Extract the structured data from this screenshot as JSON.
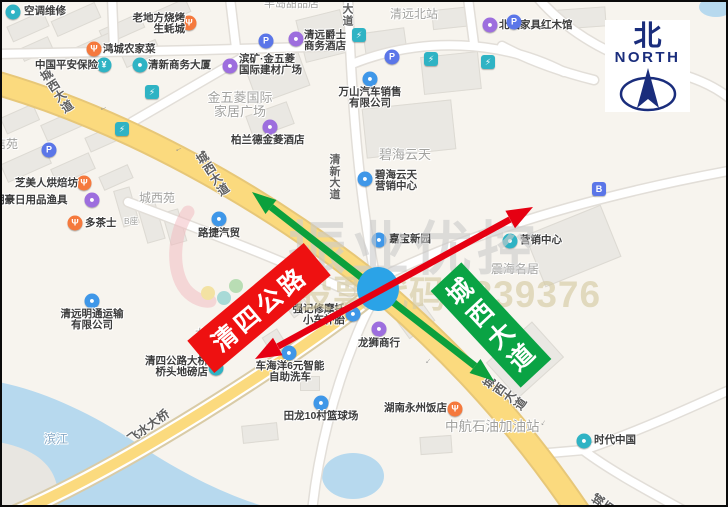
{
  "compass": {
    "zh": "北",
    "en": "NORTH"
  },
  "banners": {
    "red_label": "清四公路",
    "green_label": "城西大道"
  },
  "watermark": {
    "brand": "振业优控",
    "stock": "股票代码: 839376"
  },
  "colors": {
    "red_annotation": "#e60012",
    "green_annotation": "#0ca03c",
    "banner_red": "#ee1111",
    "banner_green": "#0aa344",
    "intersection_marker": "#2ba3e7",
    "compass_navy": "#1a2d7c",
    "main_road": "#fbda7e",
    "main_road_casing": "#e7c778",
    "minor_road": "#ffffff",
    "water": "#b7d9ee",
    "land": "#f7f4ee",
    "building": "#eae8e3",
    "poi_teal": "#2fb3c4",
    "poi_blue": "#3f97e8",
    "poi_orange": "#f5793d",
    "poi_purple": "#9d6ede",
    "poi_parking": "#5b76e8"
  },
  "road_labels": [
    {
      "t": "城西大道",
      "x": 55,
      "y": 89,
      "r": -33,
      "v": 1,
      "s": 12
    },
    {
      "t": "城西大道",
      "x": 211,
      "y": 172,
      "r": -33,
      "v": 1,
      "s": 12
    },
    {
      "t": "城西大道",
      "x": 503,
      "y": 391,
      "r": -55,
      "v": 1,
      "s": 12
    },
    {
      "t": "城西",
      "x": 602,
      "y": 502,
      "r": -55,
      "v": 1,
      "s": 12
    },
    {
      "t": "清新大道",
      "x": 333,
      "y": 176,
      "r": 0,
      "v": 1,
      "s": 11
    },
    {
      "t": "大道",
      "x": 346,
      "y": 14,
      "r": 0,
      "v": 1,
      "s": 11
    },
    {
      "t": "飞水大桥",
      "x": 146,
      "y": 424,
      "r": -36,
      "v": 0,
      "s": 12
    }
  ],
  "lane_arrows": [
    {
      "x": 101,
      "y": 105,
      "r": -20
    },
    {
      "x": 176,
      "y": 146,
      "r": -27
    },
    {
      "x": 425,
      "y": 358,
      "r": -50
    },
    {
      "x": 540,
      "y": 420,
      "r": -57
    }
  ],
  "buildings": [
    [
      6,
      16,
      38,
      15,
      -24
    ],
    [
      50,
      9,
      46,
      15,
      -24
    ],
    [
      98,
      19,
      42,
      14,
      -24
    ],
    [
      150,
      3,
      36,
      13,
      -24
    ],
    [
      18,
      40,
      30,
      12,
      -24
    ],
    [
      62,
      40,
      48,
      14,
      -24
    ],
    [
      120,
      44,
      36,
      13,
      -24
    ],
    [
      0,
      108,
      34,
      16,
      -24
    ],
    [
      40,
      114,
      40,
      16,
      -24
    ],
    [
      84,
      128,
      34,
      14,
      -24
    ],
    [
      0,
      152,
      46,
      18,
      -24
    ],
    [
      50,
      158,
      40,
      16,
      -24
    ],
    [
      98,
      168,
      30,
      13,
      -24
    ],
    [
      116,
      186,
      15,
      36,
      -16
    ],
    [
      139,
      196,
      17,
      42,
      -16
    ],
    [
      164,
      208,
      15,
      32,
      -16
    ],
    [
      248,
      58,
      54,
      34,
      -20
    ],
    [
      298,
      12,
      44,
      42,
      -14
    ],
    [
      362,
      28,
      40,
      22,
      -8
    ],
    [
      430,
      6,
      40,
      18,
      -6
    ],
    [
      556,
      6,
      46,
      18,
      -4
    ],
    [
      420,
      52,
      56,
      36,
      -6
    ],
    [
      246,
      106,
      42,
      22,
      -20
    ],
    [
      362,
      102,
      88,
      48,
      -6
    ],
    [
      530,
      216,
      80,
      54,
      -22
    ],
    [
      492,
      334,
      60,
      46,
      -42
    ],
    [
      228,
      320,
      22,
      14,
      -32
    ],
    [
      262,
      330,
      16,
      12,
      -32
    ],
    [
      298,
      374,
      18,
      13,
      0
    ],
    [
      240,
      422,
      34,
      16,
      -6
    ],
    [
      418,
      434,
      30,
      16,
      -4
    ],
    [
      398,
      308,
      30,
      20,
      -36
    ],
    [
      286,
      298,
      18,
      12,
      -36
    ]
  ],
  "roads": {
    "minor": [
      "M 374 278 C 358 200 350 110 346 -4",
      "M -4 52 L 200 48 L 344 44",
      "M 390 270 C 470 232 580 196 732 168",
      "M 110 -4 L 112 46",
      "M 228 -4 L 234 46",
      "M 130 120 L 240 56",
      "M 126 200 C 200 228 280 258 348 290",
      "M 350 62 C 420 34 500 38 562 70",
      "M 536 -4 C 560 24 600 52 648 64 C 692 74 714 84 732 100",
      "M 500 44 C 530 60 560 70 592 78",
      "M 535 452 L 582 448 C 640 428 692 404 732 386",
      "M 581 448 C 610 470 652 492 688 512",
      "M 310 510 C 316 450 332 390 352 340 C 362 314 370 300 376 292",
      "M 472 42 L 466 -4"
    ],
    "bridge": [
      "M 366 296 C 290 356 120 468 -6 520"
    ],
    "main": [
      "M -2 82 C 120 118 260 192 377 287",
      "M 377 287 C 436 338 508 408 578 512"
    ]
  },
  "pois": [
    {
      "n": "ac-repair",
      "i": [
        11,
        10,
        "teal",
        "●"
      ],
      "t": [
        22,
        4,
        [
          "空调维修"
        ],
        "dark",
        10.5,
        "l"
      ]
    },
    {
      "n": "laodifang-bbq-restaurant",
      "i": [
        187,
        21,
        "orange",
        "Ψ"
      ],
      "t": [
        183,
        11,
        [
          "老地方烧烤",
          "生蚝城"
        ],
        "dark",
        10.5,
        "r"
      ]
    },
    {
      "n": "hongcheng-farm-restaurant",
      "i": [
        92,
        47,
        "orange",
        "Ψ"
      ],
      "t": [
        101,
        42,
        [
          "鸿城农家菜"
        ],
        "dark",
        10.5,
        "l"
      ]
    },
    {
      "n": "pingan-insurance",
      "i": [
        102,
        63,
        "teal",
        "¥"
      ],
      "t": [
        96,
        58,
        [
          "中国平安保险"
        ],
        "dark",
        10.5,
        "r"
      ]
    },
    {
      "n": "qingxin-business-tower",
      "i": [
        138,
        63,
        "teal",
        "●"
      ],
      "t": [
        146,
        58,
        [
          "清新商务大厦"
        ],
        "dark",
        10.5,
        "l"
      ]
    },
    {
      "n": "binkuang-jinwuling-building-market",
      "i": [
        228,
        64,
        "purple",
        "●"
      ],
      "t": [
        237,
        52,
        [
          "滨矿·金五菱",
          "国际建材广场"
        ],
        "dark",
        10.5,
        "l"
      ]
    },
    {
      "n": "jinwuling-home-plaza",
      "t": [
        238,
        89,
        [
          "金五菱国际",
          "家居广场"
        ],
        "grey",
        13,
        "c"
      ]
    },
    {
      "n": "bolande-jinling-hotel",
      "i": [
        268,
        125,
        "purple",
        "●"
      ],
      "t": [
        229,
        133,
        [
          "柏兰德金菱酒店"
        ],
        "dark",
        10.5,
        "l"
      ]
    },
    {
      "n": "jueshi-business-hotel",
      "i": [
        294,
        37,
        "purple",
        "●"
      ],
      "t": [
        302,
        28,
        [
          "清远爵士",
          "商务酒店"
        ],
        "dark",
        10.5,
        "l"
      ]
    },
    {
      "n": "qingyuan-north-station",
      "t": [
        388,
        6,
        [
          "清远北站"
        ],
        "grey",
        12,
        "l"
      ]
    },
    {
      "n": "beizhan-furniture-hall",
      "i": [
        488,
        23,
        "purple",
        "●"
      ],
      "t": [
        497,
        18,
        [
          "北站家具红木馆"
        ],
        "dark",
        10.5,
        "l"
      ]
    },
    {
      "n": "wanshan-auto-sales",
      "i": [
        368,
        77,
        "blue",
        "●"
      ],
      "t": [
        368,
        85,
        [
          "万山汽车销售",
          "有限公司"
        ],
        "dark",
        10.5,
        "c"
      ]
    },
    {
      "n": "bihai-yuntian-area",
      "t": [
        403,
        146,
        [
          "碧海云天"
        ],
        "grey",
        13,
        "c"
      ]
    },
    {
      "n": "bihai-yuntian-sales-center",
      "i": [
        363,
        177,
        "blue",
        "●"
      ],
      "t": [
        373,
        168,
        [
          "碧海云天",
          "营销中心"
        ],
        "dark",
        10.5,
        "l"
      ]
    },
    {
      "n": "jiabao-xinyuan",
      "i": [
        377,
        238,
        "blue",
        "●"
      ],
      "t": [
        387,
        232,
        [
          "嘉宝新园"
        ],
        "dark",
        10.5,
        "l"
      ]
    },
    {
      "n": "marketing-center",
      "i": [
        508,
        239,
        "teal",
        "●"
      ],
      "t": [
        518,
        233,
        [
          "营销中心"
        ],
        "dark",
        10.5,
        "l"
      ]
    },
    {
      "n": "zhenhai-mingju-area",
      "t": [
        489,
        261,
        [
          "震海名居"
        ],
        "grey",
        12,
        "l"
      ]
    },
    {
      "n": "lujie-auto-trade",
      "i": [
        217,
        217,
        "blue",
        "●"
      ],
      "t": [
        217,
        226,
        [
          "路捷汽贸"
        ],
        "dark",
        10.5,
        "c"
      ]
    },
    {
      "n": "chengxiyuan-area",
      "t": [
        137,
        190,
        [
          "城西苑"
        ],
        "grey",
        12,
        "l"
      ]
    },
    {
      "n": "b-block",
      "t": [
        122,
        215,
        [
          "B座"
        ],
        "grey",
        8.5,
        "l"
      ]
    },
    {
      "n": "duochashi",
      "i": [
        73,
        221,
        "orange",
        "Ψ"
      ],
      "t": [
        83,
        216,
        [
          "多茶士"
        ],
        "dark",
        10.5,
        "l"
      ]
    },
    {
      "n": "zhimeiren-bakery",
      "i": [
        82,
        181,
        "orange",
        "Ψ"
      ],
      "t": [
        76,
        176,
        [
          "芝美人烘焙坊"
        ],
        "dark",
        10.5,
        "r"
      ]
    },
    {
      "n": "minghao-daily-goods-fishing",
      "i": [
        90,
        198,
        "purple",
        "●"
      ],
      "t": [
        -8,
        193,
        [
          "明豪日用品渔具"
        ],
        "dark",
        10.5,
        "l"
      ]
    },
    {
      "n": "xinyuan-area",
      "t": [
        -8,
        136,
        [
          "信苑"
        ],
        "grey",
        12,
        "l"
      ]
    },
    {
      "n": "mingtong-transport",
      "i": [
        90,
        299,
        "blue",
        "●"
      ],
      "t": [
        90,
        307,
        [
          "清远明通运输",
          "有限公司"
        ],
        "dark",
        10.5,
        "c"
      ]
    },
    {
      "n": "longxing-village",
      "t": [
        193,
        326,
        [
          "龙兴村"
        ],
        "grey",
        12,
        "l"
      ]
    },
    {
      "n": "qingsi-bridge-weigh-shop",
      "i": [
        214,
        366,
        "teal",
        "●"
      ],
      "t": [
        206,
        354,
        [
          "清四公路大桥",
          "桥头地磅店"
        ],
        "dark",
        10.5,
        "r"
      ]
    },
    {
      "n": "binjiang-river",
      "t": [
        42,
        431,
        [
          "滨江"
        ],
        "water",
        12,
        "l"
      ]
    },
    {
      "n": "qiangji-moto-repair",
      "i": [
        351,
        312,
        "blue",
        "●"
      ],
      "t": [
        343,
        302,
        [
          "强记修摩托",
          "小车补胎"
        ],
        "dark",
        10.5,
        "r"
      ]
    },
    {
      "n": "longshi-shop",
      "i": [
        377,
        327,
        "purple",
        "●"
      ],
      "t": [
        377,
        336,
        [
          "龙狮商行"
        ],
        "dark",
        10.5,
        "c"
      ]
    },
    {
      "n": "chehaiyang-carwash",
      "i": [
        287,
        351,
        "blue",
        "●"
      ],
      "t": [
        288,
        359,
        [
          "车海洋6元智能",
          "自助洗车"
        ],
        "dark",
        10.5,
        "c"
      ]
    },
    {
      "n": "tianlong-basketball-court",
      "i": [
        319,
        401,
        "blue",
        "●"
      ],
      "t": [
        319,
        409,
        [
          "田龙10村篮球场"
        ],
        "dark",
        10.5,
        "c"
      ]
    },
    {
      "n": "hunan-yongzhou-restaurant",
      "i": [
        453,
        407,
        "orange",
        "Ψ"
      ],
      "t": [
        445,
        401,
        [
          "湖南永州饭店"
        ],
        "dark",
        10.5,
        "r"
      ]
    },
    {
      "n": "zhonghang-gas-station",
      "t": [
        443,
        418,
        [
          "中航石油加油站"
        ],
        "grey",
        13.5,
        "l"
      ]
    },
    {
      "n": "shidai-china",
      "i": [
        582,
        439,
        "teal",
        "●"
      ],
      "t": [
        592,
        433,
        [
          "时代中国"
        ],
        "dark",
        10.5,
        "l"
      ]
    },
    {
      "n": "bandao-dessert-shop",
      "t": [
        262,
        -3,
        [
          "半岛甜品店"
        ],
        "grey",
        11,
        "l"
      ]
    },
    {
      "n": "parking",
      "i": [
        47,
        148,
        "parking",
        "P"
      ]
    },
    {
      "n": "parking",
      "i": [
        264,
        39,
        "parking",
        "P"
      ]
    },
    {
      "n": "parking",
      "i": [
        390,
        55,
        "parking",
        "P"
      ]
    },
    {
      "n": "parking",
      "i": [
        512,
        20,
        "parking",
        "P"
      ]
    },
    {
      "n": "charging-station",
      "i": [
        150,
        90,
        "charge",
        "⚡"
      ]
    },
    {
      "n": "charging-station",
      "i": [
        120,
        127,
        "charge",
        "⚡"
      ]
    },
    {
      "n": "charging-station",
      "i": [
        357,
        33,
        "charge",
        "⚡"
      ]
    },
    {
      "n": "charging-station",
      "i": [
        429,
        57,
        "charge",
        "⚡"
      ]
    },
    {
      "n": "charging-station",
      "i": [
        486,
        60,
        "charge",
        "⚡"
      ]
    },
    {
      "n": "bus-stop",
      "i": [
        597,
        187,
        "bus",
        "B"
      ]
    }
  ]
}
